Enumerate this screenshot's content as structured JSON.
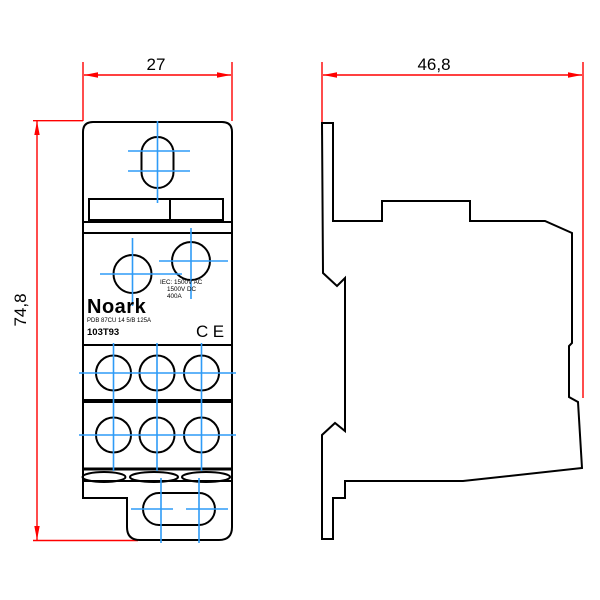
{
  "drawing": {
    "kind": "dimensioned technical drawing, front and side views of a DIN-rail power distribution block"
  },
  "dimensions": {
    "front_width_label": "27",
    "side_depth_label": "46,8",
    "height_label": "74,8"
  },
  "device": {
    "brand": "Noark",
    "rating_line1": "IEC: 1500V AC",
    "rating_line2": "1500V DC",
    "rating_line3": "400A",
    "model_line": "PDB 87CU 14 5/B 125A",
    "order_code": "103T93",
    "ce_mark": "CE"
  },
  "colors": {
    "dimension_red": "#ff0000",
    "centerline_blue": "#2e9bf7",
    "outline_black": "#000000",
    "background": "#ffffff"
  }
}
